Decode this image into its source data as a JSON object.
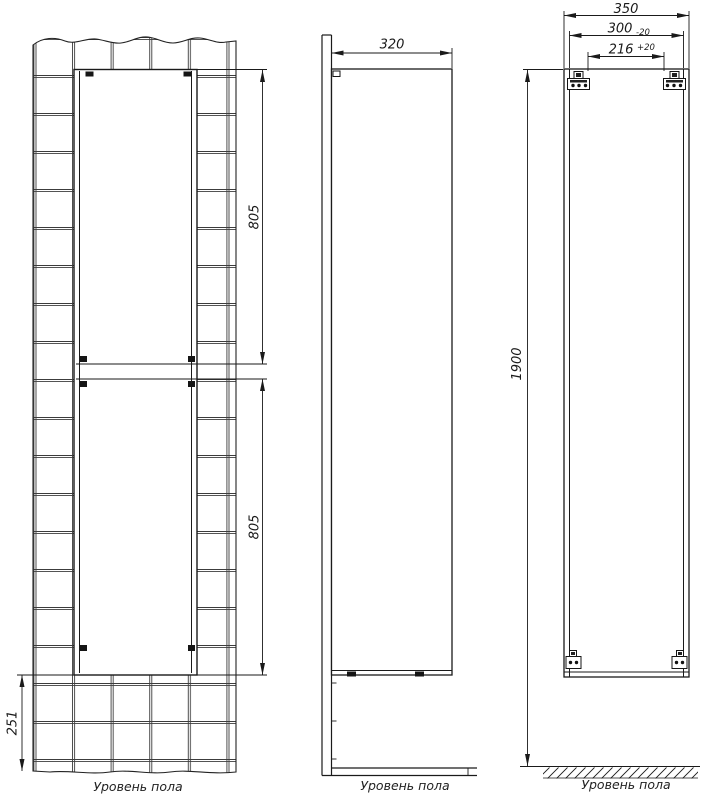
{
  "drawing": {
    "front_view": {
      "upper_door_height": "805",
      "lower_door_height": "805",
      "floor_clearance": "251",
      "floor_label": "Уровень пола"
    },
    "side_view": {
      "depth": "320",
      "floor_label": "Уровень пола"
    },
    "back_view": {
      "overall_width": "350",
      "mount_span": "300",
      "mount_span_tolerance": "-20",
      "mount_pitch": "216",
      "mount_pitch_tolerance": "+20",
      "overall_height": "1900",
      "floor_label": "Уровень пола"
    },
    "colors": {
      "line": "#1a1a1a",
      "tile_line": "#3c3c3c",
      "background": "#ffffff"
    }
  }
}
